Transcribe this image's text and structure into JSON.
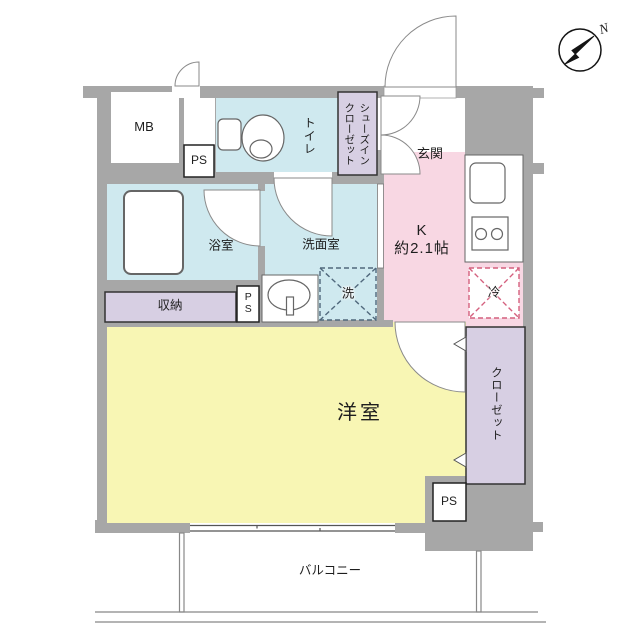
{
  "labels": {
    "mb": "MB",
    "ps": "PS",
    "toilet": "トイレ",
    "shoes_closet_col1": "シューズイン",
    "shoes_closet_col2": "クローゼット",
    "entrance": "玄関",
    "kitchen_name": "K",
    "kitchen_size": "約2.1帖",
    "bathroom": "浴室",
    "washroom": "洗面室",
    "washer": "洗",
    "fridge": "冷",
    "storage": "収納",
    "main_room": "洋室",
    "closet": "クローゼット",
    "balcony": "バルコニー",
    "north": "N"
  },
  "colors": {
    "wall": "#a7a7a7",
    "wet_area": "#cfe9ef",
    "kitchen": "#f8d7e3",
    "main_room": "#f8f6b4",
    "closet": "#d7cfe3",
    "washer_dash": "#50687c",
    "fridge_dash": "#d4607e",
    "fixture_line": "#666666",
    "door_line": "#8a8a8a"
  }
}
